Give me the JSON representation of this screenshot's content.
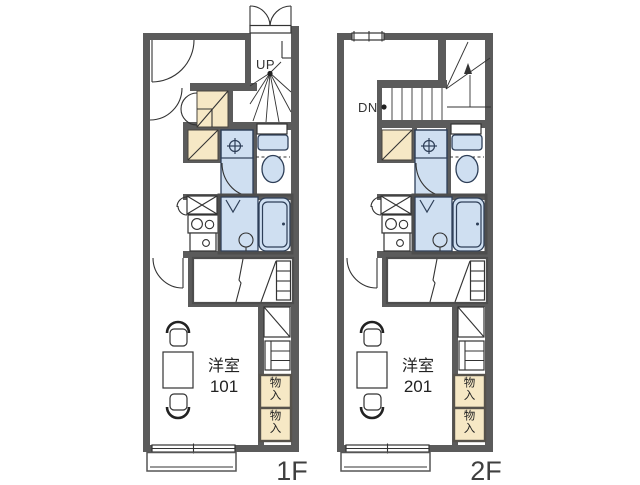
{
  "page": {
    "background": "#ffffff"
  },
  "colors": {
    "background": "#ffffff",
    "wall": "#5b5b5b",
    "wet_fill": "#cfdff1",
    "wet_stroke": "#2e3f58",
    "storage_fill": "#f6e8c5",
    "line": "#333333",
    "label": "#3f3f3f"
  },
  "floors": [
    {
      "floor_label": "1F",
      "stair_label": "UP",
      "room_name": "洋室",
      "room_number": "101",
      "closets": [
        "物入",
        "物入"
      ]
    },
    {
      "floor_label": "2F",
      "stair_label": "DN",
      "room_name": "洋室",
      "room_number": "201",
      "closets": [
        "物入",
        "物入"
      ]
    }
  ]
}
